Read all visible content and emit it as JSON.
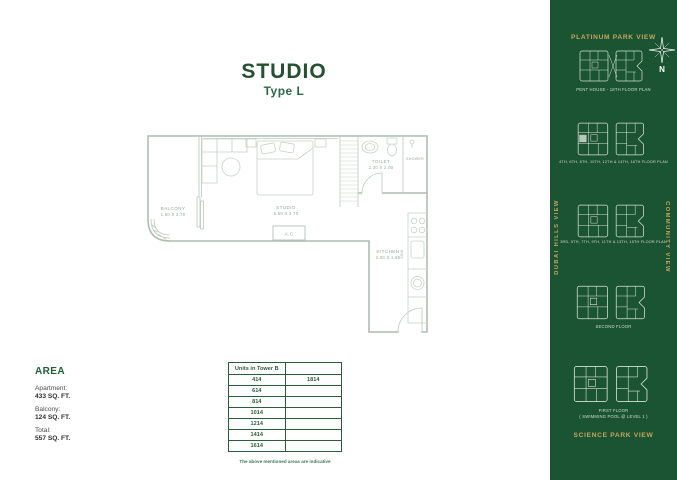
{
  "colors": {
    "sidebar_bg": "#1b5433",
    "gold_accent": "#c9a45f",
    "title_green": "#255032",
    "table_green": "#2b5d3b",
    "plan_line": "#aebdb2"
  },
  "header": {
    "title": "STUDIO",
    "subtitle": "Type L"
  },
  "plan": {
    "balcony": "BALCONY",
    "balcony_dims": "1.60 X 3.70",
    "studio": "STUDIO",
    "studio_dims": "5.50 X 3.70",
    "toilet": "TOILET",
    "toilet_dims": "2.30 X 2.00",
    "shower": "SHOWER",
    "kitchen": "KITCHEN",
    "kitchen_dims": "3.00 X 1.85",
    "sink": "SINK",
    "ac": "A.C"
  },
  "area": {
    "heading": "AREA",
    "apartment_label": "Apartment:",
    "apartment_value": "433 SQ. FT.",
    "balcony_label": "Balcony:",
    "balcony_value": "124 SQ. FT.",
    "total_label": "Total:",
    "total_value": "557 SQ. FT."
  },
  "units_table": {
    "header": "Units in Tower B",
    "rows": [
      [
        "414",
        "1814"
      ],
      [
        "614",
        ""
      ],
      [
        "814",
        ""
      ],
      [
        "1014",
        ""
      ],
      [
        "1214",
        ""
      ],
      [
        "1414",
        ""
      ],
      [
        "1614",
        ""
      ]
    ]
  },
  "note": "The above mentioned areas are indicative",
  "sidebar": {
    "top_view_label": "PLATINUM PARK VIEW",
    "bottom_view_label": "SCIENCE PARK VIEW",
    "left_view_label": "DUBAI HILLS VIEW",
    "right_view_label": "COMMUNITY VIEW",
    "compass_n": "N",
    "keyplans": [
      {
        "caption": "PENT HOUSE - 18TH FLOOR PLAN",
        "caption2": ""
      },
      {
        "caption": "4TH, 6TH, 8TH, 10TH, 12TH & 14TH, 16TH FLOOR PLAN",
        "caption2": ""
      },
      {
        "caption": "3RD, 5TH, 7TH, 9TH, 11TH & 13TH, 15TH FLOOR PLAN",
        "caption2": ""
      },
      {
        "caption": "SECOND FLOOR",
        "caption2": ""
      },
      {
        "caption": "FIRST FLOOR",
        "caption2": "( SWIMMING POOL @ LEVEL 1 )"
      }
    ]
  }
}
